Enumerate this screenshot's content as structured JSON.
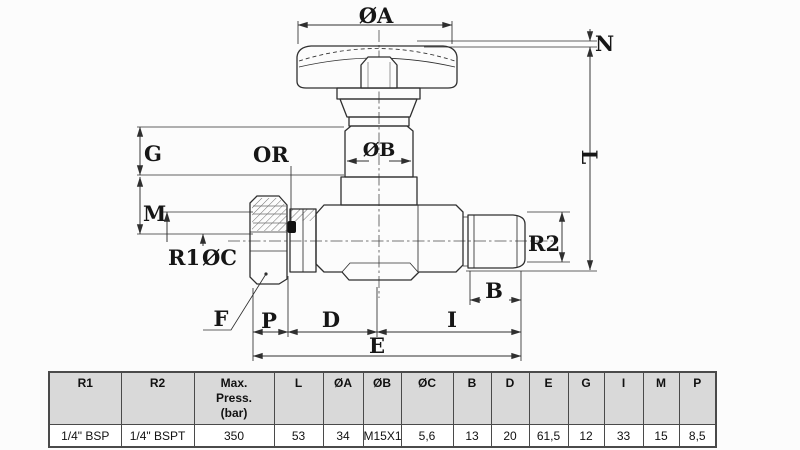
{
  "colors": {
    "background": "#fcfcfc",
    "line": "#2f2f2f",
    "dim_line": "#2f2f2f",
    "table_border": "#4a4a4a",
    "table_header_bg": "#d9d9d9",
    "oring": "#111111"
  },
  "diagram": {
    "labels": {
      "dia_a": "ØA",
      "n": "N",
      "l": "L",
      "g": "G",
      "or": "OR",
      "dia_b": "ØB",
      "m": "M",
      "r1": "R1",
      "dia_c": "ØC",
      "r2": "R2",
      "f": "F",
      "b": "B",
      "p": "P",
      "d": "D",
      "i": "I",
      "e": "E"
    }
  },
  "table": {
    "headers": [
      "R1",
      "R2",
      "Max.\nPress.\n(bar)",
      "L",
      "ØA",
      "ØB",
      "ØC",
      "B",
      "D",
      "E",
      "G",
      "I",
      "M",
      "P"
    ],
    "row": [
      "1/4\" BSP",
      "1/4\" BSPT",
      "350",
      "53",
      "34",
      "M15X1",
      "5,6",
      "13",
      "20",
      "61,5",
      "12",
      "33",
      "15",
      "8,5"
    ]
  }
}
